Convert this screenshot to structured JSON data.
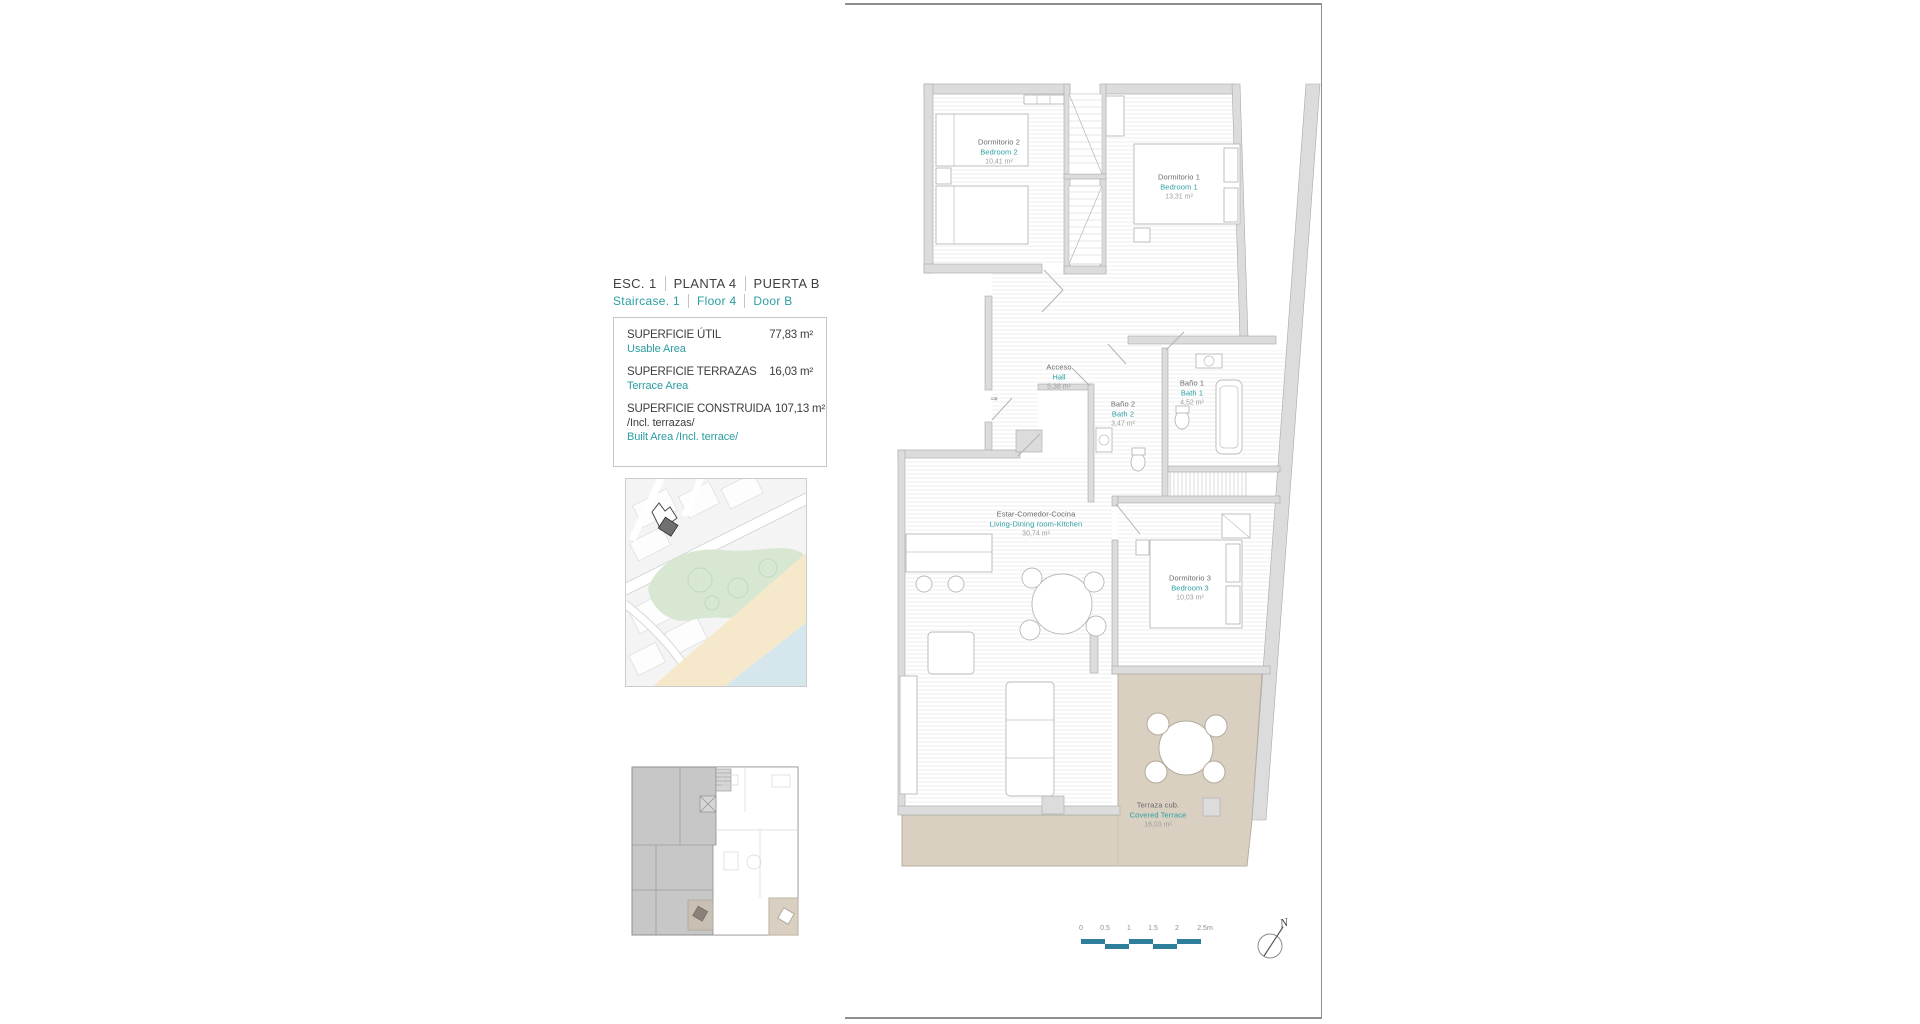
{
  "header": {
    "title_es": [
      "ESC.  1",
      "PLANTA  4",
      "PUERTA B"
    ],
    "title_en": [
      "Staircase.  1",
      "Floor  4",
      "Door B"
    ]
  },
  "area_table": {
    "rows": [
      {
        "label": "SUPERFICIE ÚTIL",
        "sublabel": "Usable Area",
        "value": "77,83 m²"
      },
      {
        "label": "SUPERFICIE TERRAZAS",
        "sublabel": "Terrace Area",
        "value": "16,03 m²"
      },
      {
        "label": "SUPERFICIE CONSTRUIDA",
        "sublabel": "/Incl. terrazas/",
        "sublabel2": "Built Area /Incl. terrace/",
        "value": "107,13 m²"
      }
    ]
  },
  "floor_plan": {
    "rooms": [
      {
        "es": "Dormitorio 2",
        "en": "Bedroom 2",
        "area": "10,41 m²"
      },
      {
        "es": "Dormitorio 1",
        "en": "Bedroom 1",
        "area": "13,31 m²"
      },
      {
        "es": "Acceso",
        "en": "Hall",
        "area": "5,38 m²"
      },
      {
        "es": "Baño 1",
        "en": "Bath 1",
        "area": "4,52 m²"
      },
      {
        "es": "Baño 2",
        "en": "Bath 2",
        "area": "3,47 m²"
      },
      {
        "es": "Estar-Comedor-Cocina",
        "en": "Living-Dining room-Kitchen",
        "area": "30,74 m²"
      },
      {
        "es": "Dormitorio 3",
        "en": "Bedroom 3",
        "area": "10,03 m²"
      },
      {
        "es": "Terraza cub.",
        "en": "Covered Terrace",
        "area": "16,03 m²"
      }
    ],
    "entrance_symbol": "⇒"
  },
  "scale_bar": {
    "labels": [
      "0",
      "0.5",
      "1",
      "1.5",
      "2",
      "2.5m"
    ]
  },
  "compass": {
    "label": "N"
  },
  "colors": {
    "teal": "#2B9EA1",
    "scalebar": "#2F7E9B",
    "wall": "#DCDCDC",
    "terrace": "#D9D0C2"
  }
}
